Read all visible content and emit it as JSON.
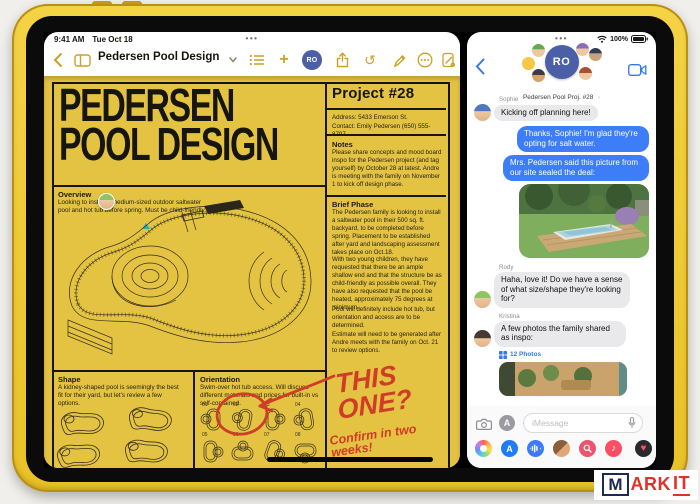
{
  "device": {
    "time": "9:41 AM",
    "date": "Tue Oct 18",
    "battery_percent": "100%"
  },
  "brand": {
    "monogram": "RO"
  },
  "icons": {
    "chevron_left": "‹",
    "chevron_right": "›",
    "plus": "+",
    "undo": "↺",
    "handle_dots": "•••",
    "status_dots": "•••",
    "music_note": "♪",
    "heart": "♥",
    "app_store_letter": "A"
  },
  "colors": {
    "ios_blue": "#007AFF",
    "bubble_blue": "#3D7DF7",
    "bubble_gray": "#E9E9EB",
    "notes_gold": "#C9A125",
    "page_yellow": "#E4C342",
    "marker_red": "#CF3C28",
    "logo_navy": "#4B5FA6",
    "device_yellow": "#F2CF3A"
  },
  "notes_app": {
    "toolbar": {
      "title": "Pedersen Pool Design"
    },
    "document": {
      "title_line1": "PEDERSEN",
      "title_line2": "POOL DESIGN",
      "project": "Project #28",
      "address": "Address: 5433 Emerson St.",
      "contact": "Contact: Emily Pedersen (650) 555-8797",
      "notes_heading": "Notes",
      "notes_body": "Please share concepts and mood board inspo for the Pedersen project (and tag yourself) by October 28 at latest. Andre is meeting with the family on November 1 to kick off design phase.",
      "overview_heading": "Overview",
      "overview_body": "Looking to install a medium-sized outdoor saltwater pool and hot tub before spring. Must be child-friendly.",
      "brief_heading": "Brief Phase",
      "brief_p1": "The Pedersen family is looking to install a saltwater pool in their 500 sq. ft. backyard, to be completed before spring. Placement to be established after yard and landscaping assessment takes place on Oct.18.",
      "brief_p2": "With two young children, they have requested that there be an ample shallow end and that the structure be as child-friendly as possible overall. They have also requested that the pool be heated, approximately 75 degrees at minimum.",
      "brief_p3": "Pool will definitely include hot tub, but orientation and access are to be determined.",
      "brief_p4": "Estimate will need to be generated after Andre meets with the family on Oct. 21 to review options.",
      "shape_heading": "Shape",
      "shape_body": "A kidney-shaped pool is seemingly the best fit for their yard, but let's review a few options.",
      "orientation_heading": "Orientation",
      "orientation_body": "Swim-over hot tub access. Will discuss different materials and prices for built-in vs self-contained.",
      "orientation_numbers": [
        "01",
        "02",
        "03",
        "04",
        "05",
        "06",
        "07",
        "08"
      ],
      "annotation_this_one": "THIS ONE?",
      "annotation_confirm": "Confirm in two weeks!"
    }
  },
  "messages_app": {
    "header": {
      "title": "Pedersen Pool Proj. #28"
    },
    "conversation": [
      {
        "sender": "Sophie",
        "type": "received",
        "text": "Kicking off planning here!"
      },
      {
        "type": "sent",
        "text": "Thanks, Sophie! I'm glad they're opting for salt water."
      },
      {
        "type": "sent",
        "text": "Mrs. Pedersen said this picture from our site sealed the deal:"
      },
      {
        "type": "sent-image",
        "text": ""
      },
      {
        "sender": "Rody",
        "type": "received",
        "text": "Haha, love it! Do we have a sense of what size/shape they're looking for?"
      },
      {
        "sender": "Kristina",
        "type": "received",
        "text": "A few photos the family shared as inspo:"
      }
    ],
    "photos_badge": "12 Photos",
    "input_placeholder": "iMessage"
  },
  "watermark": {
    "boxed": "M",
    "part1": "ARK",
    "part2": "IT"
  }
}
